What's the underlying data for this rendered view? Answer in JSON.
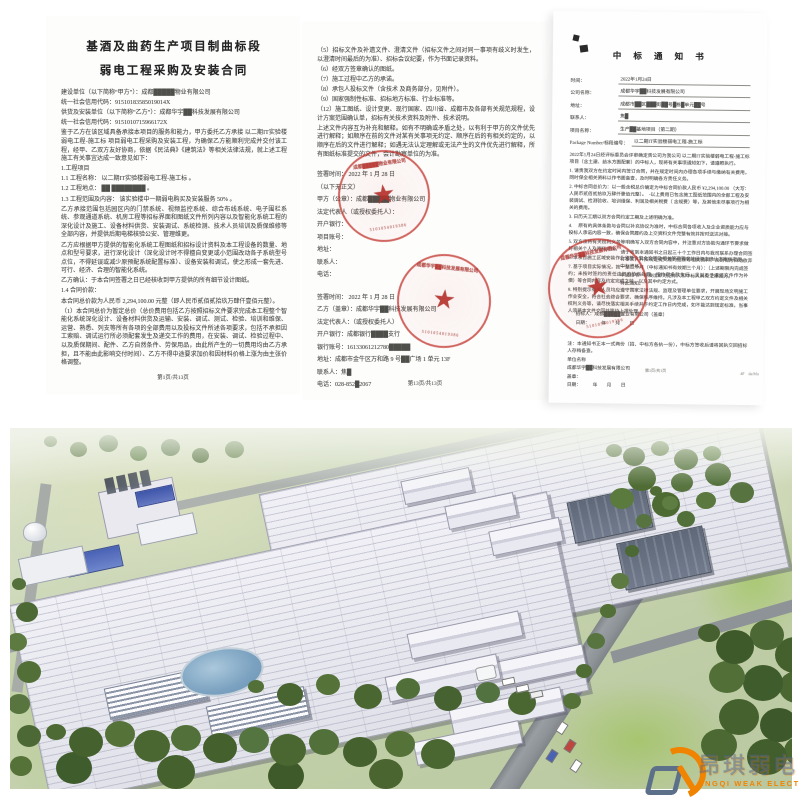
{
  "icons": {
    "star": "★"
  },
  "documents": {
    "doc1": {
      "title1": "基酒及曲药生产项目制曲标段",
      "title2": "弱电工程采购及安装合同",
      "body": [
        "建设单位（以下简称“甲方”）：成都█████物业有限公司",
        "统一社会信用代码：91510183585019014X",
        "供货及安装单位（以下简称“乙方”）：成都华宇██科技发展有限公司",
        "统一社会信用代码：9151010715966172X",
        "鉴于乙方在该区域具备承接本项目的服务和能力，甲方委托乙方承接 以二期IT实验楼弱电工程-施工标 项目弱电工程采购及安装工程，为确保乙方能顺利完成并交付该工程，经甲、乙双方友好协商，依据《民法典》《建筑法》等相关法律法规，就上述工程施工有关事宜达成一致意见如下：",
        "1.工程项目",
        "1.1 工程名称：  以二期IT实验楼弱电工程-施工标  。",
        "1.2 工程地点：  ██  ████████  。",
        "1.3 工程范围及内容：  该实验楼中一期弱电购买及安装服务 50%  。",
        "乙方承接范围包括园区内的门禁系统、视频监控系统、综合布线系统、电子围栏系统、参观通道系统、机房工程等招标界面和图纸文件所列内容以及智能化系统工程的深化设计及施工、设备材料供货、安装调试、系统检测、技术人员培训及质保维修等全部内容，并提供后期电梯核验公安、管理维更。",
        "乙方应根据甲方提供的智能化系统工程图纸和招标设计资料及本工程设备的数量、地点和型号要求，进行深化设计（深化设计时不得擅自变更或小范围改动各子系统型号点位，不得延误或减少原预配系统配置标准）、设备安装和调试，使之形成一套先进、可行、经济、合理的智能化系统。",
        "乙方确认：于本合同签署之日已经核收到甲方提供的所有细节设计图纸。",
        "1.4 合同价款：",
        "本合同总价款为人民币 2,294,100.00 元整（即人民币贰佰贰拾玖万肆仟壹佰元整）。",
        "（1）本合同总价为暂定总价（总价费用包括乙方按照招标文件要求完成本工程整个智能化系统深化设计、设备材料供货及运输、安装、调试、测试、检验、培训和维保、运营、熟悉、列支等所有各项的全部费用以及投标文件所述各项要求，包括不承担因工索赔、调试运行所必须配套发生及递交工作的费用，在安装、调试、检验过程中、以及质保期间、配件、乙方自然条件、劳保用品，由此所产生的一切费用均由乙方承担，且不能由此影响交付时间）、乙方不得中途要求加价和因材料价格上涨为由主张价格调整。"
      ],
      "footer": "第1页/共13页"
    },
    "doc2": {
      "body": [
        "（5）招标文件及补遗文件、澄清文件（招标文件之间对同一事项有歧义时发生，以澄清时间最后的为准）、招标会议纪要，作为书面记录资料。",
        "（6）经双方签章确认的图纸。",
        "（7）施工过程中乙方的承诺。",
        "（8）承包人投标文件（含技术 及商务部分，见附件）。",
        "（9）国家强制性标准、招标地方标准、行业标准等。",
        "（12）施工图纸、设计变更、现行国家、四川省、成都市及各部有关规范规程，设计方案范围确认单，招标有关技术资料及附件、技术说明。",
        "上述文件内容互为补充和解释。如有不明确或矛盾之处，以有利于甲方的文件优先进行解释；如顺序在前的文件对某有关事项无约定、顺序在后的有相关约定的，以顺序在后的文件进行解释；如遇无法认定理解或无法产生的文件优先进行解释，所有图纸标准提交的文件，会计勘察单位的为准。"
      ],
      "sign_a": [
        "签署时间： 2022 年  1 月  28 日",
        "（以下无正文）",
        "甲方（公章）：成都█████物业有限公司",
        "法定代表人（或授权委托人）：",
        "开户银行：",
        "项目账号：",
        "地址：",
        "联系人：",
        "电话："
      ],
      "sign_b": [
        "签署时间： 2022 年  1 月  28 日",
        "乙方（盖章）：成都华宇██科技发展有限公司",
        "法定代表人：（或授权委托人）",
        "开户银行：成都银行████支行",
        "银行账号：16133061212780█████",
        "地址：成都市金牛区万和路 9 号██广场 1 单元 13F",
        "联系人：焦█",
        "电话：028-852█2067"
      ],
      "footer": "第13页/共13页"
    },
    "doc3": {
      "title": "中 标 通 知 书",
      "fields": [
        {
          "label": "时间：",
          "value": "2022年1月24日"
        },
        {
          "label": "公司名称：",
          "value": "成都华宇██科技发展有限公司"
        },
        {
          "label": "地址：",
          "value": "成都市██区███街██号█栋█单元██号"
        },
        {
          "label": "联系人：",
          "value": "焦█"
        },
        {
          "label": "项目名称：",
          "value": "生产██基地项目（第二期）"
        },
        {
          "label": "Package Number/标段编号：",
          "value": "以二期IT实验楼弱电工程-施工标"
        }
      ],
      "intro": "2022年1月24日经评标委员会评审确定贵公司为我公司 以二期IT实验楼弱电工程-施工标 项目（含土建、给水方面配套）的中标人，现将有关事项通知如下，请遵照执行。",
      "items": [
        "1. 请贵我双方在约定时间内签订合同，并在规定时间内办理各项手续与缴纳有关费用，同时保全相关资料以作书面备查，及时明确各方责任义务。",
        "2. 中标合同总价为：以一般含税总价确定为中标合同价款人民币 ¥2,294,100.00 （大写：人民币贰佰贰拾玖万肆仟壹佰元整）。　-以上费用已包含施工图纸范围内的全部工程及安装调试、检测验收、培训维保、利润及相关税费（ 含规费）等，及其他未尽事项行为相关的费用。",
        "3. 日历天工期以双方合同约定工期及上述明确为准。",
        "4. 　原有的具体条款与合同以补充协议为准时，中标合同各项收入及企业资质能力应与投标人承诺内容一致，确保合同履约及上交资料文件完整有效并按时送达对接。",
        "5. 双方须将有关权利义务等明确写入双方合同内容中，并注意对方协助沟通环节要求做好相关个人及资料对接。",
        "6. 本项目施工区域安装作业须符合安全文明及相关管理要求并经双方确认方案后实施。",
        "7. 基于项目实际情况，按一至二个月（中标通知书有效期三个月）：（上述期限内完成签约；未按时签约的责任由双方协商处理，按约定条款执行，且以不予退还文件作为补偿）等合同内容及约定完成之前，以及其中约定方式。",
        "8. 特别提示有关人员均应遵守国家法律法规、监理及管理单位要求，开展现场文明施工作业安全，符合社会综合要求、确保秩序维持。凡涉及本工程甲乙双方约定文件及相关权利义务等，请尽快落实相关手续并于约定工作日内完成，如不能达到规定标准，当事人须将本文件交回并等待上报处理。"
      ],
      "closing": [
        "请于收到本通知书之日起三十个工作日内与我司联系办理合同签订事宜，并按规定提交履约担保等相关资料，否则视为自动放弃中标资格。",
        "本通知书一经发出即对招标人和中标人具有法律效力。",
        "特此通知。"
      ],
      "issuer": [
        "招标人：成都█████置业有限公司（盖章）",
        "日期：　　　年　　月　　日"
      ],
      "notes": [
        "注：本通知书正本一式两份（招、中标方各执一份），中标方签收后请将回执交回招标人存档备查。",
        "单位名称",
        "成都华宇██科技发展有限公司",
        "盖章：",
        "日期：　　　年　　月　　日"
      ],
      "page_note": "第1页/共1页",
      "corner_note": "4F　da/Mo"
    }
  },
  "seals": {
    "party_a_text": "成都█████物业有限公司",
    "party_b_text": "成都华宇██科技发展有限公司",
    "bidder_text": "成都华宇██科技发展有限公司",
    "number": "5101054019386",
    "color": "#c12c26"
  },
  "rendering": {
    "roof_color": "#eaeaf1",
    "field_color": "#c6d2ad",
    "forest_color": "#4c6834",
    "road_color": "#8e9397",
    "pond_color": "#7ba2c0"
  },
  "logo": {
    "cn": "昂琪弱电",
    "en": "ANGQI WEAK ELECTRICITY",
    "orange": "#f08300",
    "blue_gray": "#5c7089"
  }
}
